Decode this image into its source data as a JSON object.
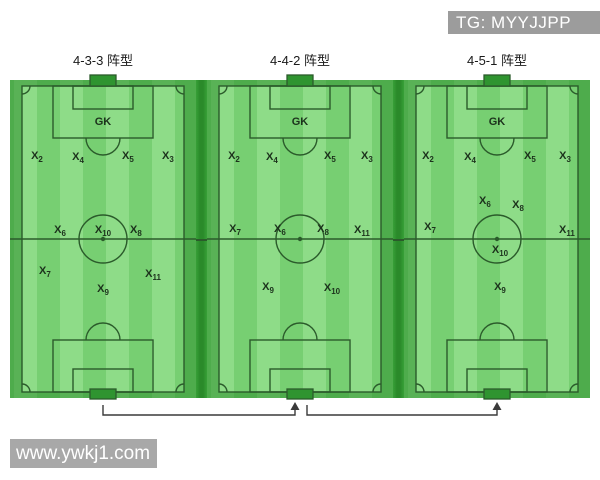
{
  "watermarks": {
    "top": "TG: MYYJJPP",
    "bottom": "www.ywkj1.com"
  },
  "colors": {
    "grass-light": "#8edc88",
    "grass-mid": "#77cf72",
    "grass-dark": "#2e8f2e",
    "line": "#2b5b2b",
    "goal": "#2f9430",
    "badge-gray": "#9c9c9c",
    "badge-gray2": "#a8a8a8",
    "title-text": "#1a1a1a",
    "player-text": "#1c321c",
    "arrow": "#3a3a3a"
  },
  "fields": [
    {
      "title": "4-3-3 阵型",
      "players": [
        {
          "label": "GK",
          "x": 50,
          "y": 14.7
        },
        {
          "label": "X",
          "sub": "2",
          "x": 14.5,
          "y": 25.5
        },
        {
          "label": "X",
          "sub": "4",
          "x": 36.6,
          "y": 25.8
        },
        {
          "label": "X",
          "sub": "5",
          "x": 63.4,
          "y": 25.5
        },
        {
          "label": "X",
          "sub": "3",
          "x": 84.9,
          "y": 25.5
        },
        {
          "label": "X",
          "sub": "6",
          "x": 26.9,
          "y": 48.2
        },
        {
          "label": "X",
          "sub": "10",
          "x": 50,
          "y": 48.2
        },
        {
          "label": "X",
          "sub": "8",
          "x": 67.7,
          "y": 48.2
        },
        {
          "label": "X",
          "sub": "7",
          "x": 18.8,
          "y": 60.7
        },
        {
          "label": "X",
          "sub": "11",
          "x": 76.9,
          "y": 61.7
        },
        {
          "label": "X",
          "sub": "9",
          "x": 50,
          "y": 66.3
        }
      ]
    },
    {
      "title": "4-4-2 阵型",
      "players": [
        {
          "label": "GK",
          "x": 50,
          "y": 14.7
        },
        {
          "label": "X",
          "sub": "2",
          "x": 14.5,
          "y": 25.5
        },
        {
          "label": "X",
          "sub": "4",
          "x": 34.9,
          "y": 25.8
        },
        {
          "label": "X",
          "sub": "5",
          "x": 66.1,
          "y": 25.5
        },
        {
          "label": "X",
          "sub": "3",
          "x": 86.0,
          "y": 25.5
        },
        {
          "label": "X",
          "sub": "7",
          "x": 15.1,
          "y": 47.9
        },
        {
          "label": "X",
          "sub": "6",
          "x": 39.2,
          "y": 47.9
        },
        {
          "label": "X",
          "sub": "8",
          "x": 62.4,
          "y": 47.9
        },
        {
          "label": "X",
          "sub": "11",
          "x": 83.3,
          "y": 48.2
        },
        {
          "label": "X",
          "sub": "9",
          "x": 32.8,
          "y": 65.6
        },
        {
          "label": "X",
          "sub": "10",
          "x": 67.2,
          "y": 66.0
        }
      ]
    },
    {
      "title": "4-5-1 阵型",
      "players": [
        {
          "label": "GK",
          "x": 50,
          "y": 14.7
        },
        {
          "label": "X",
          "sub": "2",
          "x": 12.9,
          "y": 25.5
        },
        {
          "label": "X",
          "sub": "4",
          "x": 35.5,
          "y": 25.8
        },
        {
          "label": "X",
          "sub": "5",
          "x": 67.7,
          "y": 25.5
        },
        {
          "label": "X",
          "sub": "3",
          "x": 86.6,
          "y": 25.5
        },
        {
          "label": "X",
          "sub": "6",
          "x": 43.5,
          "y": 39.3
        },
        {
          "label": "X",
          "sub": "8",
          "x": 61.3,
          "y": 40.5
        },
        {
          "label": "X",
          "sub": "7",
          "x": 14.0,
          "y": 47.2
        },
        {
          "label": "X",
          "sub": "11",
          "x": 87.6,
          "y": 48.2
        },
        {
          "label": "X",
          "sub": "10",
          "x": 51.6,
          "y": 54.3
        },
        {
          "label": "X",
          "sub": "9",
          "x": 51.6,
          "y": 65.6
        }
      ]
    }
  ]
}
